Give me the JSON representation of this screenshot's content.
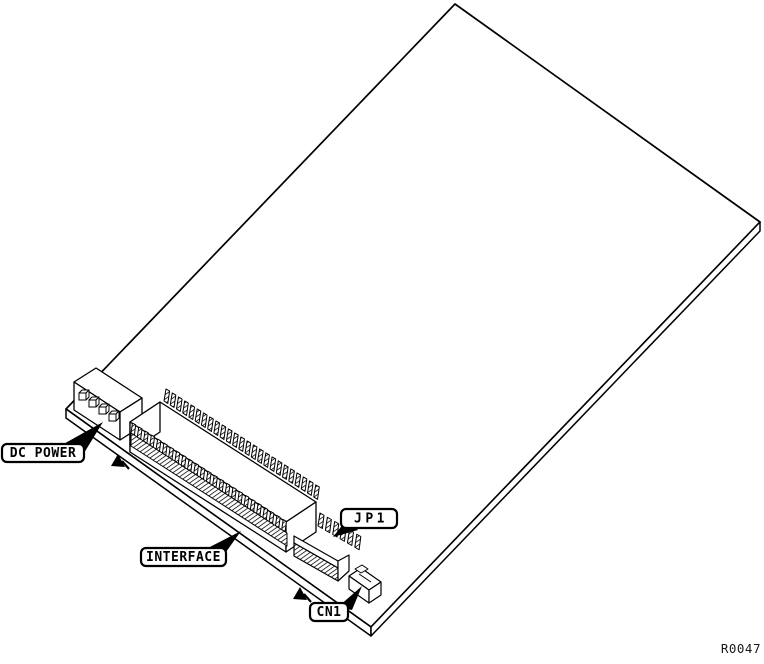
{
  "figure": {
    "callouts": {
      "dc_power": "DC POWER",
      "interface": "INTERFACE",
      "jp1": "JP1",
      "cn1": "CN1"
    },
    "figure_number": "R0047",
    "colors": {
      "line": "#000000",
      "background": "#ffffff"
    }
  }
}
